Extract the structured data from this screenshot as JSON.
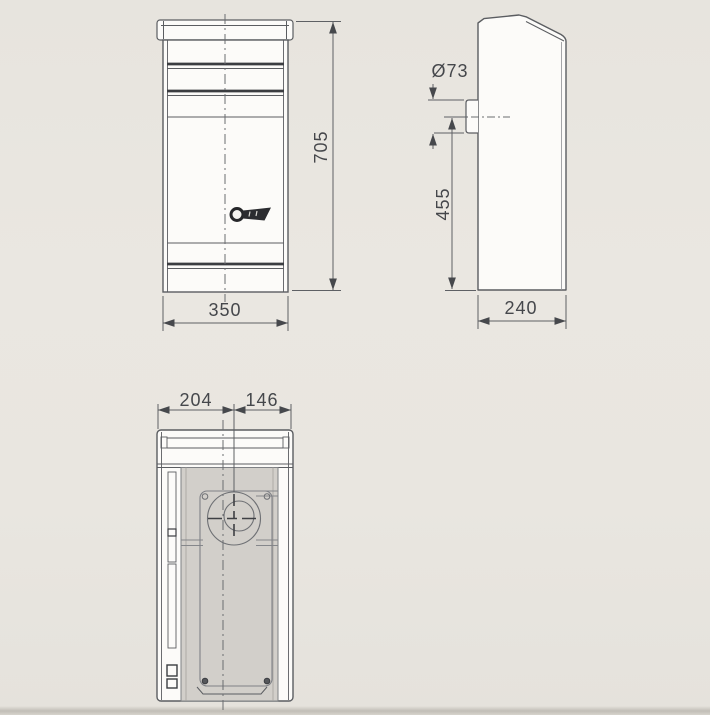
{
  "drawing": {
    "kind": "mailbox-dimension-drawing",
    "views": {
      "front": {
        "label": "front-view",
        "height_dim": "705",
        "width_dim": "350"
      },
      "side": {
        "label": "side-view",
        "inlet_diameter_dim": "Ø73",
        "inlet_center_height_dim": "455",
        "depth_dim": "240"
      },
      "back": {
        "label": "back-view",
        "center_offset_left_dim": "204",
        "center_offset_right_dim": "146"
      }
    },
    "icons": {
      "lock_logo": "lock-logo-icon"
    },
    "colors": {
      "background": "#e8e5df",
      "outline": "#5b5d61",
      "heavy_line": "#3b3d41",
      "body_fill": "#fcfbf9",
      "panel_gray": "#d2cfca",
      "dimension_text": "#45474b"
    }
  }
}
